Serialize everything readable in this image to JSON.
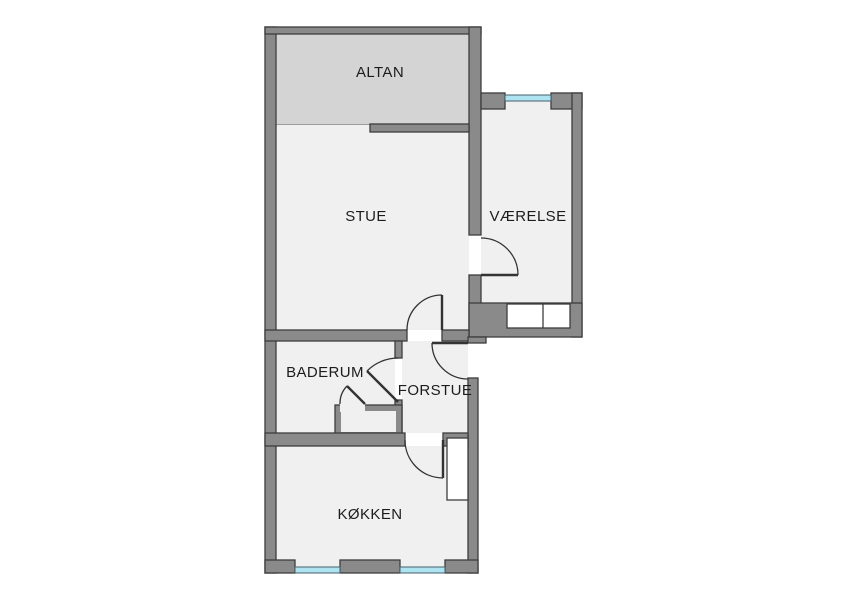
{
  "plan": {
    "type": "apartment-floor-plan",
    "rooms": {
      "altan": {
        "label": "ALTAN"
      },
      "stue": {
        "label": "STUE"
      },
      "vaerelse": {
        "label": "VÆRELSE"
      },
      "baderum": {
        "label": "BADERUM"
      },
      "forstue": {
        "label": "FORSTUE"
      },
      "koekken": {
        "label": "KØKKEN"
      }
    }
  },
  "colors": {
    "background": "#ffffff",
    "wall": "#8a8a8a",
    "wall_outline": "#3d3d3d",
    "room_fill": "#f0f0f0",
    "balcony_fill": "#d4d4d4",
    "balcony_outline": "#666666",
    "window": "#aee4f2",
    "window_outline": "#44606b",
    "furniture_fill": "#ffffff",
    "door_line": "#333333",
    "label_text": "#1c1c1c"
  }
}
